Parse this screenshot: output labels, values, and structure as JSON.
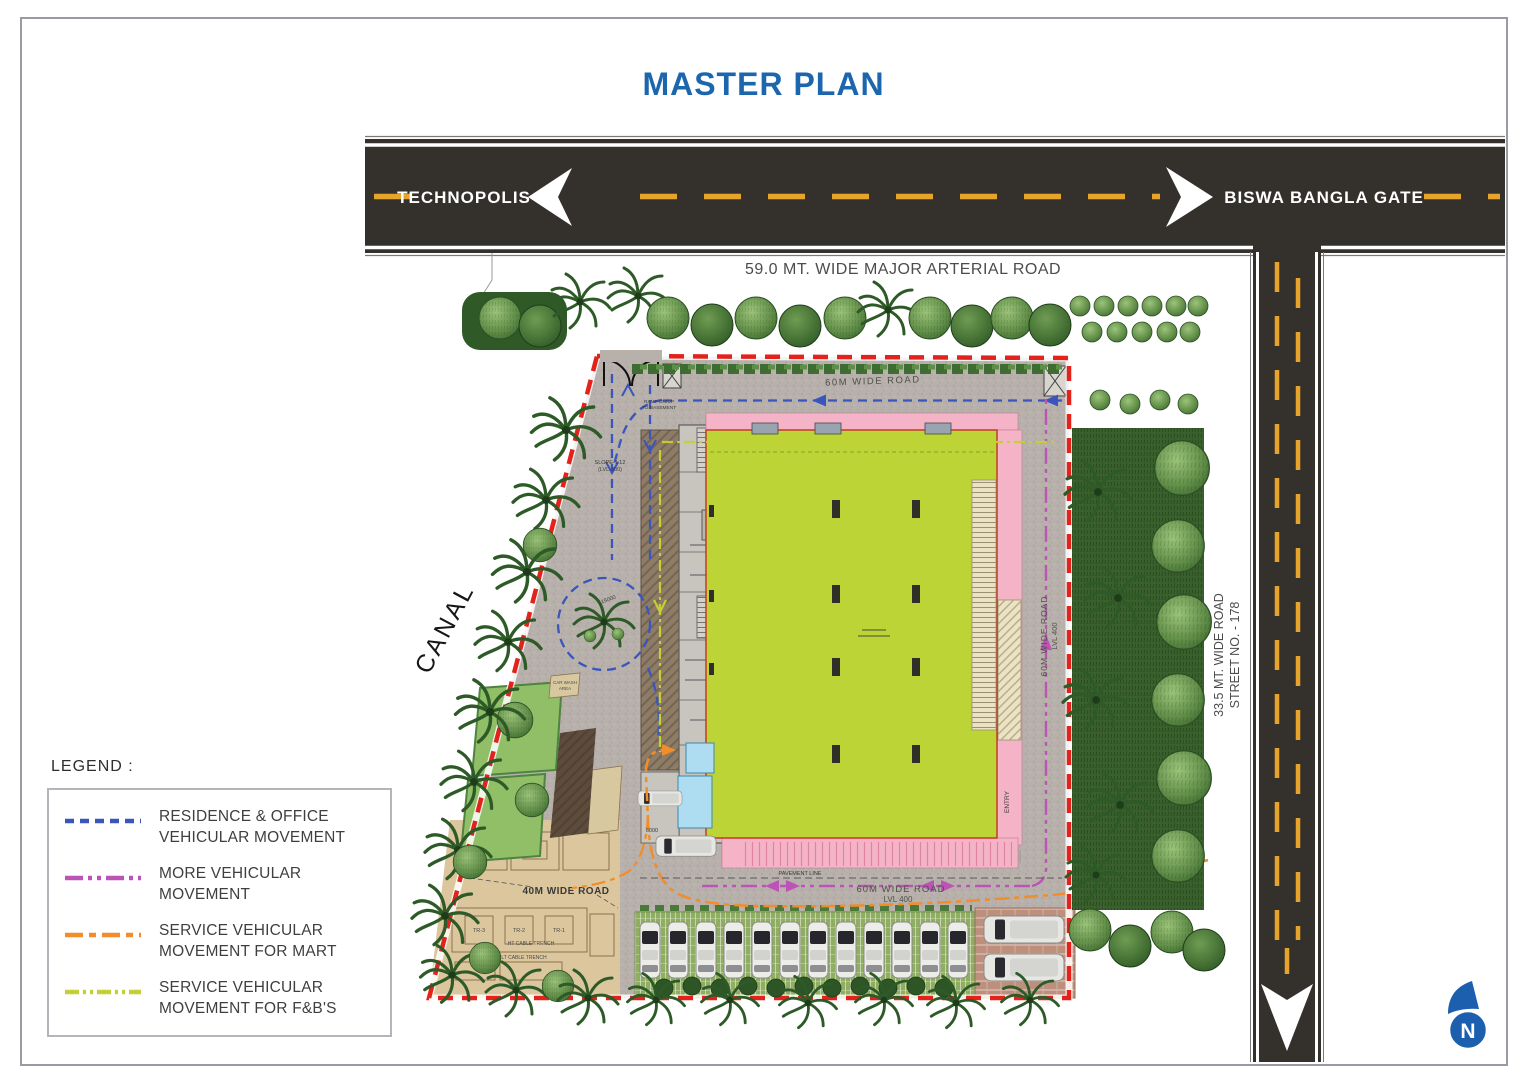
{
  "title": "MASTER PLAN",
  "arterial_road": {
    "left_destination": "TECHNOPOLIS",
    "right_destination": "BISWA BANGLA GATE",
    "caption": "59.0 MT. WIDE MAJOR ARTERIAL ROAD"
  },
  "street_road": {
    "name": "33.5 MT. WIDE ROAD",
    "number": "STREET NO. - 178"
  },
  "canal_label": "CANAL",
  "internal_roads": {
    "north": "60M WIDE ROAD",
    "east_name": "60M WIDE ROAD",
    "east_level": "LVL 400",
    "south_name": "60M WIDE ROAD",
    "south_level": "LVL 400",
    "yard": "40M WIDE ROAD"
  },
  "site_labels": {
    "slope": "SLOPE-1:12",
    "slope_level": "(LVL-300)",
    "ramp_line1": "RAMP DN/UP",
    "ramp_line2": "TO BASEMENT",
    "entry": "ENTRY",
    "pavement_line": "PAVEMENT LINE",
    "car_wash_line1": "CAR WASH",
    "car_wash_line2": "AREA",
    "ht_trench": "HT CABLE TRENCH",
    "lt_trench": "LT CABLE TRENCH",
    "transformers": [
      "TR-3",
      "TR-2",
      "TR-1"
    ],
    "dim_15000": "15000",
    "dim_6000": "6000"
  },
  "legend": {
    "heading": "LEGEND :",
    "items": [
      {
        "line1": "RESIDENCE & OFFICE",
        "line2": "VEHICULAR MOVEMENT",
        "color": "#3a55bd"
      },
      {
        "line1": "MORE VEHICULAR",
        "line2": "MOVEMENT",
        "color": "#bb54b6"
      },
      {
        "line1": "SERVICE VEHICULAR",
        "line2": "MOVEMENT FOR MART",
        "color": "#f28d2a"
      },
      {
        "line1": "SERVICE VEHICULAR",
        "line2": "MOVEMENT FOR F&B'S",
        "color": "#c3d035"
      }
    ]
  },
  "compass": {
    "label": "N"
  },
  "colors": {
    "title_blue": "#1c66ae",
    "road_dark": "#34302c",
    "road_yellow": "#e7a42c",
    "boundary_red": "#e3231b",
    "building_green": "#bcd435",
    "building_pink": "#f4b3c6",
    "north_blue": "#1b5fae"
  }
}
